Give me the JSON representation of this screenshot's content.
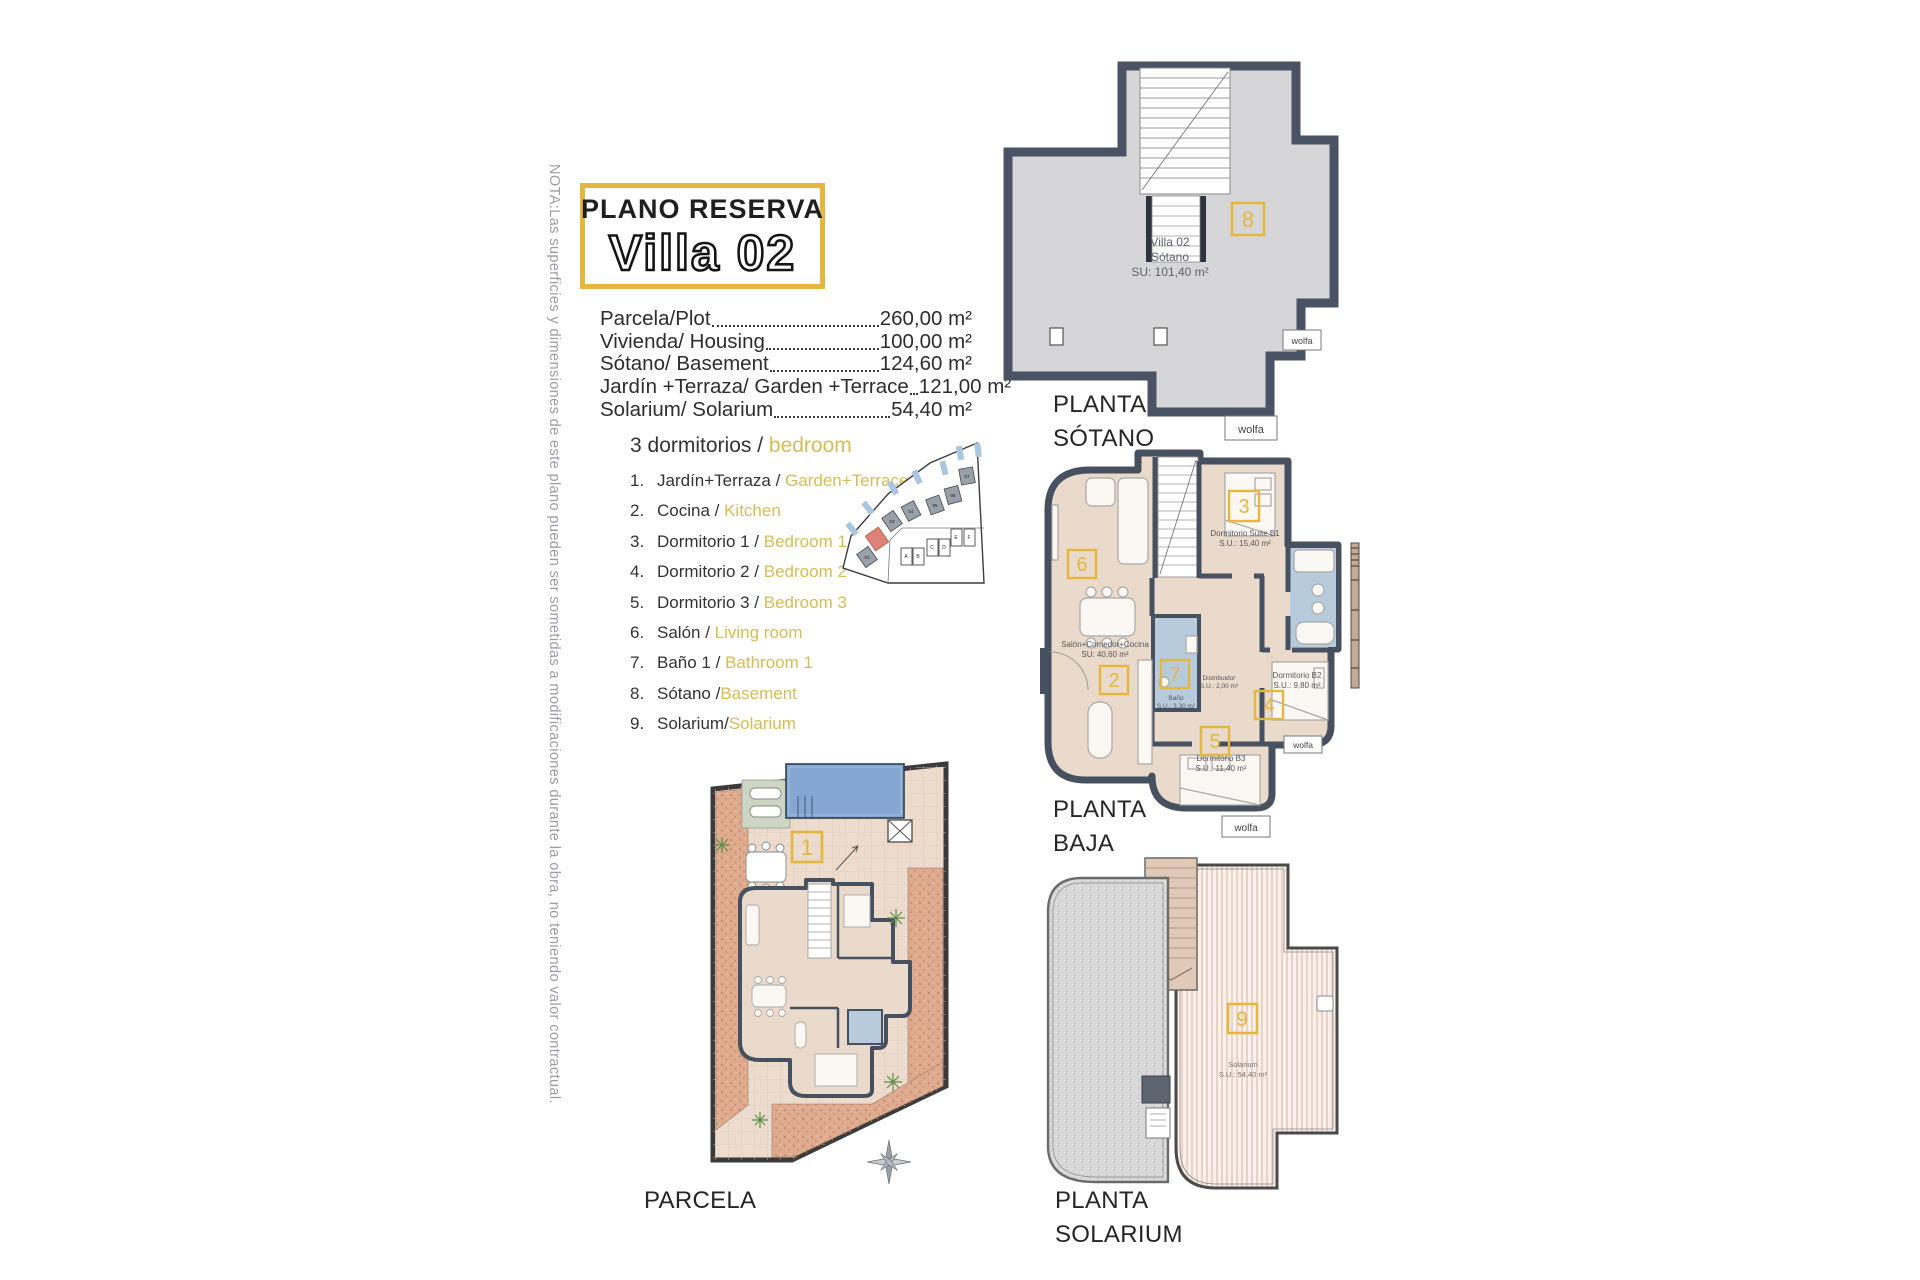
{
  "note": "NOTA:Las superficies y dimensiones de este plano pueden ser sometidas a modificaciones durante la obra, no teniendo valor contractual.",
  "title": {
    "kicker": "PLANO RESERVA",
    "name": "Villa 02"
  },
  "areas": [
    {
      "label": "Parcela/Plot",
      "value": "260,00 m²"
    },
    {
      "label": "Vivienda/ Housing",
      "value": "100,00 m²"
    },
    {
      "label": "Sótano/ Basement",
      "value": "124,60 m²"
    },
    {
      "label": "Jardín +Terraza/ Garden +Terrace",
      "value": "121,00 m²"
    },
    {
      "label": "Solarium/ Solarium",
      "value": "54,40 m²"
    }
  ],
  "legend": {
    "heading_es": "3 dormitorios / ",
    "heading_en": "bedroom",
    "items": [
      {
        "num": "1.",
        "es": "Jardín+Terraza / ",
        "en": "Garden+Terrace"
      },
      {
        "num": "2.",
        "es": "Cocina / ",
        "en": "Kitchen"
      },
      {
        "num": "3.",
        "es": "Dormitorio 1 / ",
        "en": "Bedroom 1"
      },
      {
        "num": "4.",
        "es": "Dormitorio 2 / ",
        "en": "Bedroom 2"
      },
      {
        "num": "5.",
        "es": "Dormitorio 3 / ",
        "en": "Bedroom 3"
      },
      {
        "num": "6.",
        "es": "Salón / ",
        "en": "Living room"
      },
      {
        "num": "7.",
        "es": "Baño 1 / ",
        "en": "Bathroom 1"
      },
      {
        "num": "8.",
        "es": "Sótano /",
        "en": "Basement"
      },
      {
        "num": "9.",
        "es": "Solarium/",
        "en": "Solarium"
      }
    ]
  },
  "site_map": {
    "villa_labels": [
      "01",
      "03",
      "04",
      "05",
      "06",
      "07"
    ],
    "row_labels": [
      "A",
      "B",
      "C",
      "D",
      "E",
      "F"
    ]
  },
  "tags": {
    "sotano": "8",
    "baja": [
      "6",
      "3",
      "2",
      "7",
      "4",
      "5"
    ],
    "parcela": "1",
    "solarium": "9"
  },
  "plans": {
    "sotano": {
      "label": [
        "PLANTA",
        "SÓTANO"
      ],
      "room": {
        "line1": "Villa 02",
        "line2": "Sótano",
        "line3": "SU: 101,40 m²"
      },
      "logo": "wolfa"
    },
    "baja": {
      "label": [
        "PLANTA",
        "BAJA"
      ],
      "rooms": [
        {
          "name": "Dormitorio Suite B1",
          "area": "S.U.: 15,40 m²"
        },
        {
          "name": "Salón+Comedor+Cocina",
          "area": "SU: 40,60 m²"
        },
        {
          "name": "Distribuidor",
          "area": "S.U.: 2,00 m²"
        },
        {
          "name": "Baño",
          "area": "S.U.: 3,30 m²"
        },
        {
          "name": "Dormitorio B2",
          "area": "S.U.: 9,80 m²"
        },
        {
          "name": "Dormitorio B3",
          "area": "S.U.: 11,40 m²"
        }
      ],
      "logo": "wolfa"
    },
    "parcela": {
      "label": "PARCELA"
    },
    "solarium": {
      "label": [
        "PLANTA",
        "SOLARIUM"
      ],
      "room": {
        "name": "Solarium",
        "area": "S.U.: 54,40 m²"
      }
    }
  },
  "colors": {
    "accent_yellow": "#E6B73F",
    "legend_yellow": "#D8BC52",
    "wall_dark": "#4A5363",
    "floor_gray": "#D6D6D8",
    "floor_beige": "#EADACB",
    "bath_blue": "#B7CBDD",
    "pool_blue": "#84A7D2",
    "highlight_red": "#DD8276",
    "deck_green": "#CCD6C3",
    "garden_terracotta": "#DFAB8E"
  }
}
